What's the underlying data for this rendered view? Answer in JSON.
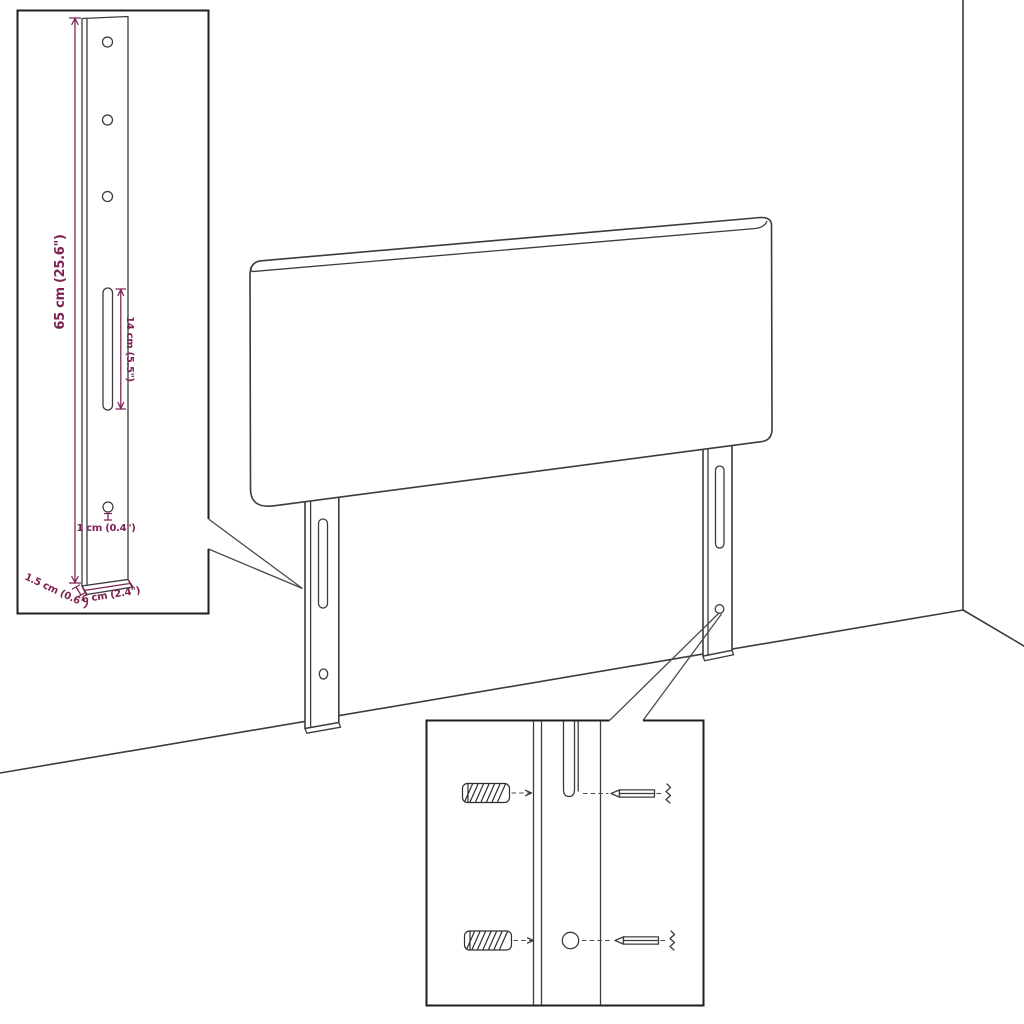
{
  "illustration": {
    "kind": "furniture-assembly-diagram",
    "subject": "headboard with two mounting legs, wall corner background, leg detail inset and screw mounting inset",
    "colors": {
      "line": "#3c3c3c",
      "inset_border": "#1f1f1f",
      "dimension": "#7e2253",
      "background": "#ffffff"
    }
  },
  "dimensions": {
    "leg_height": "65 cm (25.6\")",
    "slot_length": "14 cm (5.5\")",
    "hole_diameter": "1 cm (0.4\")",
    "base_depth": "1.5 cm (0.6\")",
    "leg_width": "6 cm (2.4\")"
  }
}
